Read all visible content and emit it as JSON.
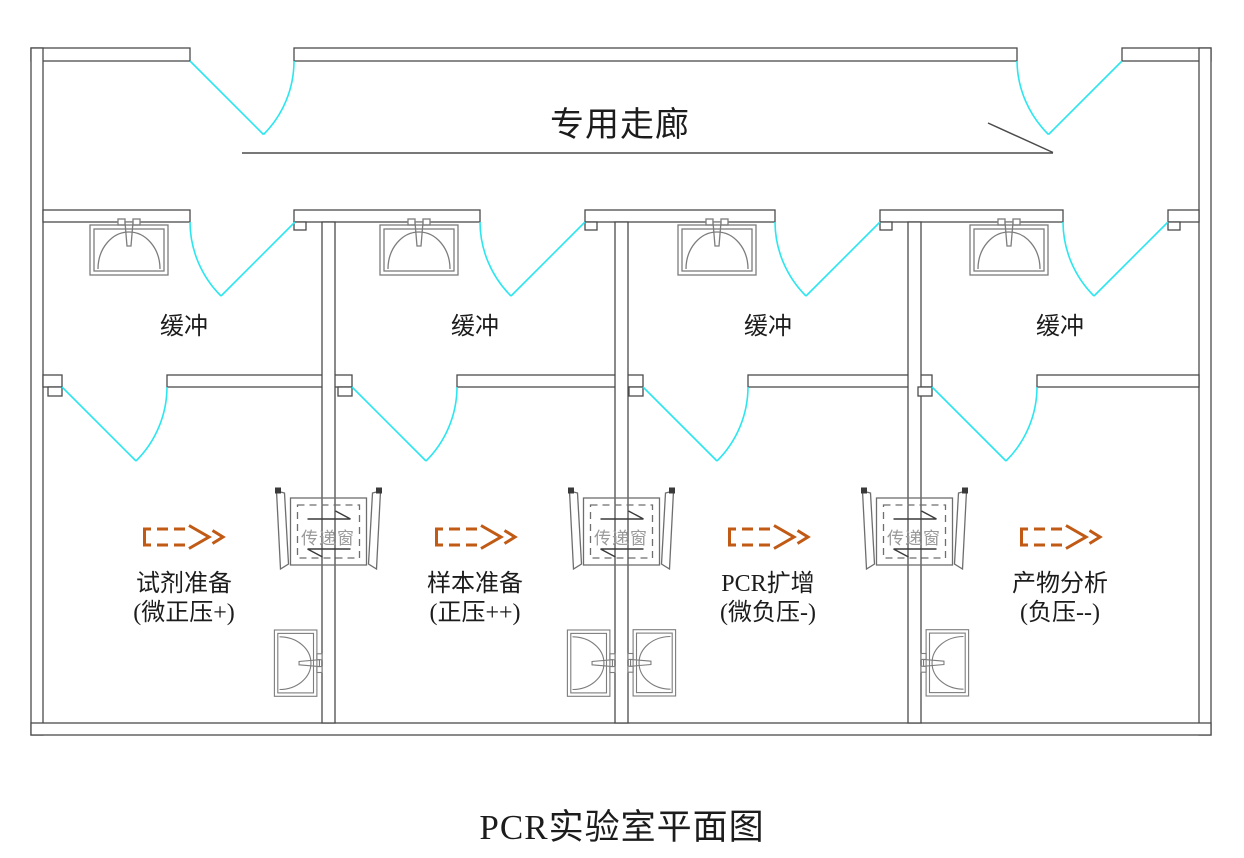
{
  "title": "PCR实验室平面图",
  "corridor": {
    "label": "专用走廊"
  },
  "buffers": [
    "缓冲",
    "缓冲",
    "缓冲",
    "缓冲"
  ],
  "rooms": [
    {
      "name": "试剂准备",
      "pressure": "(微正压+)"
    },
    {
      "name": "样本准备",
      "pressure": "(正压++)"
    },
    {
      "name": "PCR扩增",
      "pressure": "(微负压-)"
    },
    {
      "name": "产物分析",
      "pressure": "(负压--)"
    }
  ],
  "pass_window": {
    "label": "传递窗"
  },
  "icons": {
    "door": "door-swing-arc",
    "sink": "sink-with-faucet",
    "airflow": "dashed-hollow-arrow-right",
    "pass_window": "pass-through-window-box"
  },
  "colors": {
    "wall": "#4b4b4b",
    "door_swing": "#2ae6ef",
    "airflow_arrow": "#c05a15",
    "pass_window_label": "#9a9a9a",
    "text": "#1c1c1c"
  }
}
